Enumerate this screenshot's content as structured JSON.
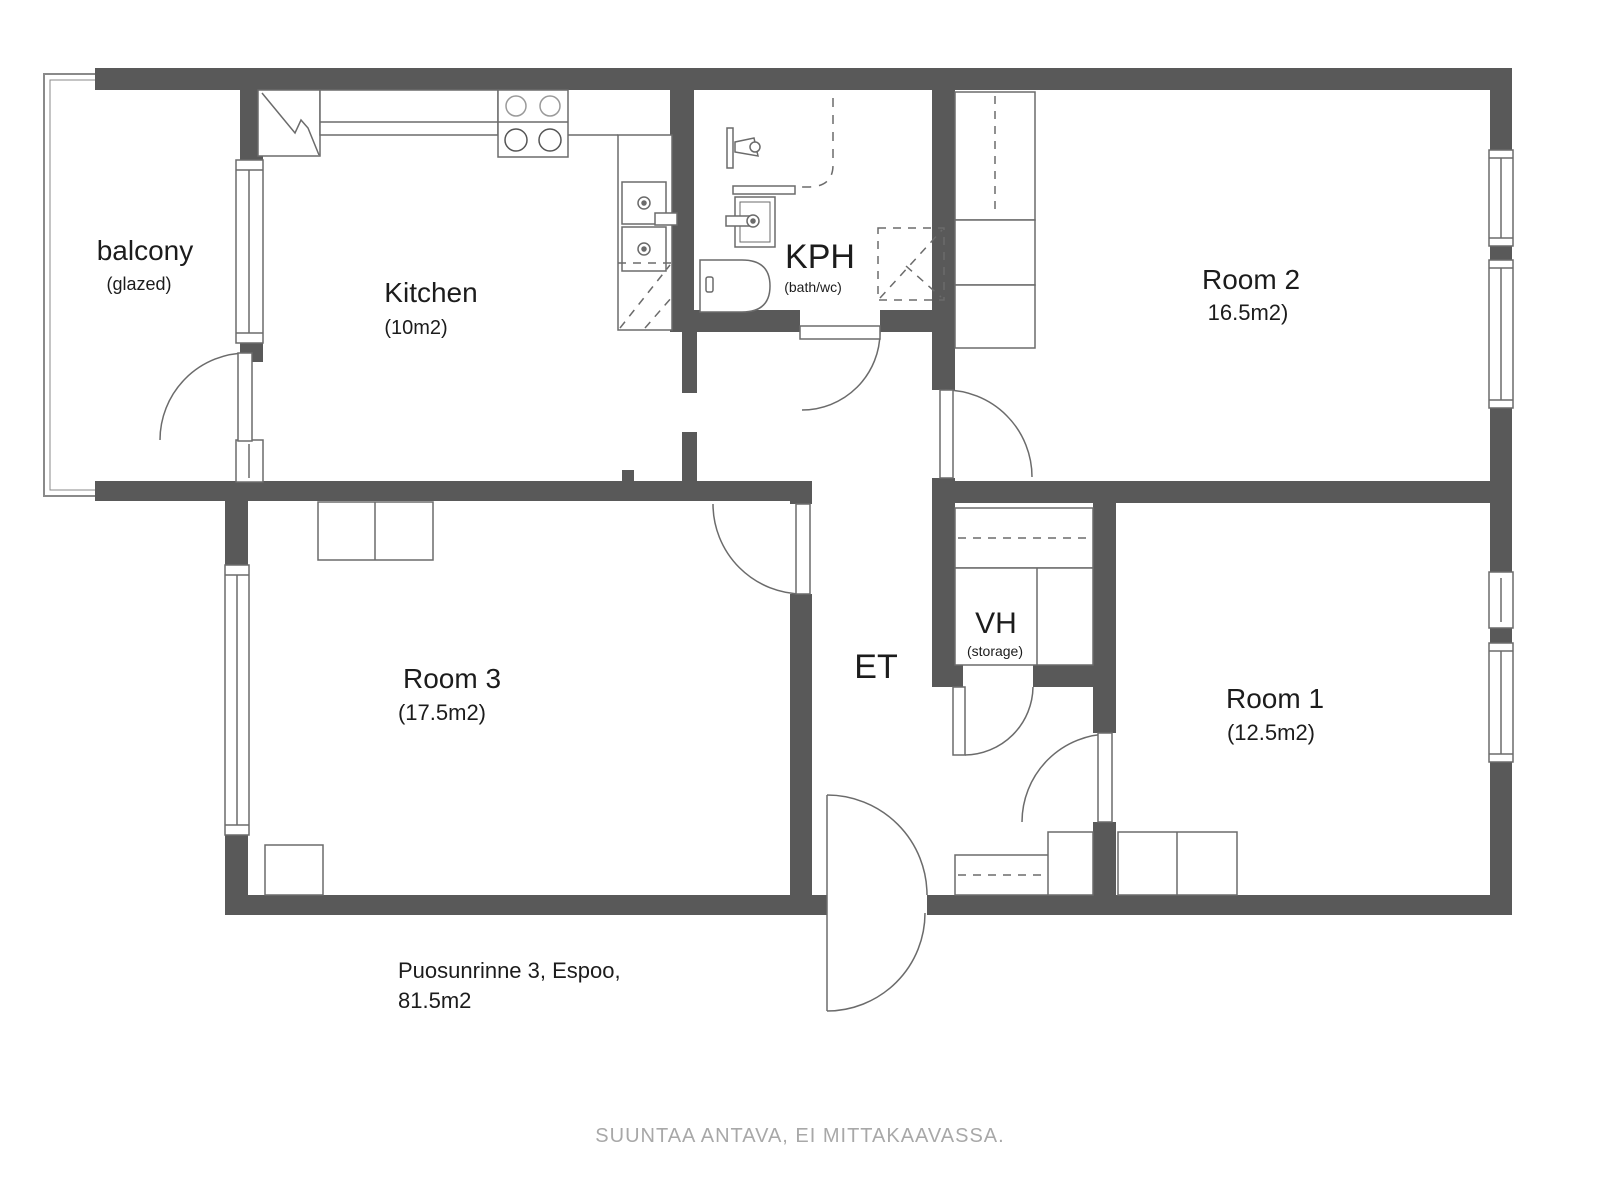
{
  "plan": {
    "address_line1": "Puosunrinne 3, Espoo,",
    "address_line2": "81.5m2",
    "footer_note": "SUUNTAA ANTAVA, EI MITTAKAAVASSA.",
    "colors": {
      "wall": "#595959",
      "furniture_line": "#6b6b6b",
      "text": "#1c1c1c",
      "muted": "#a8a8a8"
    },
    "rooms": {
      "balcony": {
        "name": "balcony",
        "detail": "(glazed)"
      },
      "kitchen": {
        "name": "Kitchen",
        "detail": "(10m2)"
      },
      "kph": {
        "name": "KPH",
        "detail": "(bath/wc)"
      },
      "room2": {
        "name": "Room 2",
        "detail": "16.5m2)"
      },
      "room3": {
        "name": "Room 3",
        "detail": "(17.5m2)"
      },
      "et": {
        "name": "ET"
      },
      "vh": {
        "name": "VH",
        "detail": "(storage)"
      },
      "room1": {
        "name": "Room 1",
        "detail": "(12.5m2)"
      }
    },
    "fixtures": {
      "fridge": "refrigerator",
      "stove": "stove-4-burners",
      "kitchen_sinks": "double-sink",
      "dishwasher": "dishwasher-reserved",
      "shower": "shower",
      "bath_sink": "washbasin",
      "toilet": "toilet",
      "washer": "washing-machine-reserved"
    }
  }
}
